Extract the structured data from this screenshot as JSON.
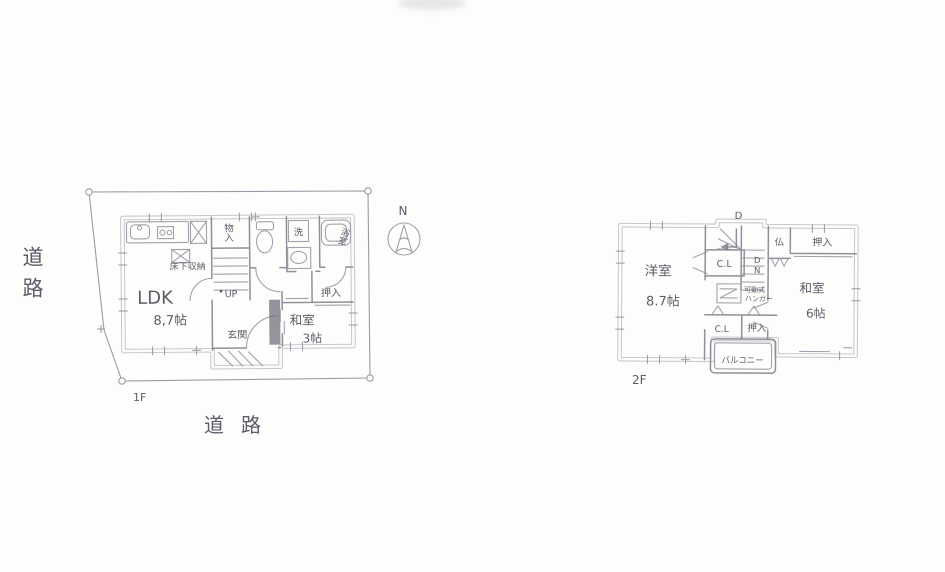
{
  "colors": {
    "paper": "#fdfdfc",
    "pencil_wall": "#9d9da8",
    "pencil_line": "#84848f",
    "ink_text": "#5c5c68"
  },
  "site": {
    "road_label_left": "道路",
    "road_label_bottom": "道路",
    "north_label": "N"
  },
  "floor1": {
    "label": "1F",
    "ldk": {
      "name": "LDK",
      "size": "8,7帖"
    },
    "floor_storage": "床下収納",
    "storage": "物入",
    "stairs_up": "UP",
    "laundry": "洗",
    "bath": "浴室",
    "closet": "押入",
    "washitsu": {
      "name": "和室",
      "size": "3帖"
    },
    "entrance": "玄関"
  },
  "floor2": {
    "label": "2F",
    "western_room": {
      "name": "洋室",
      "size": "8.7帖"
    },
    "closet_upper": "C.L",
    "closet_lower": "C.L",
    "altar": "仏",
    "oshiire_top": "押入",
    "oshiire_mid": "押入",
    "washitsu": {
      "name": "和室",
      "size": "6帖"
    },
    "hanger": {
      "line1": "可動式",
      "line2": "ハンガー"
    },
    "balcony": "バルコニー",
    "stair_top": "D",
    "stair_down": "DN"
  }
}
